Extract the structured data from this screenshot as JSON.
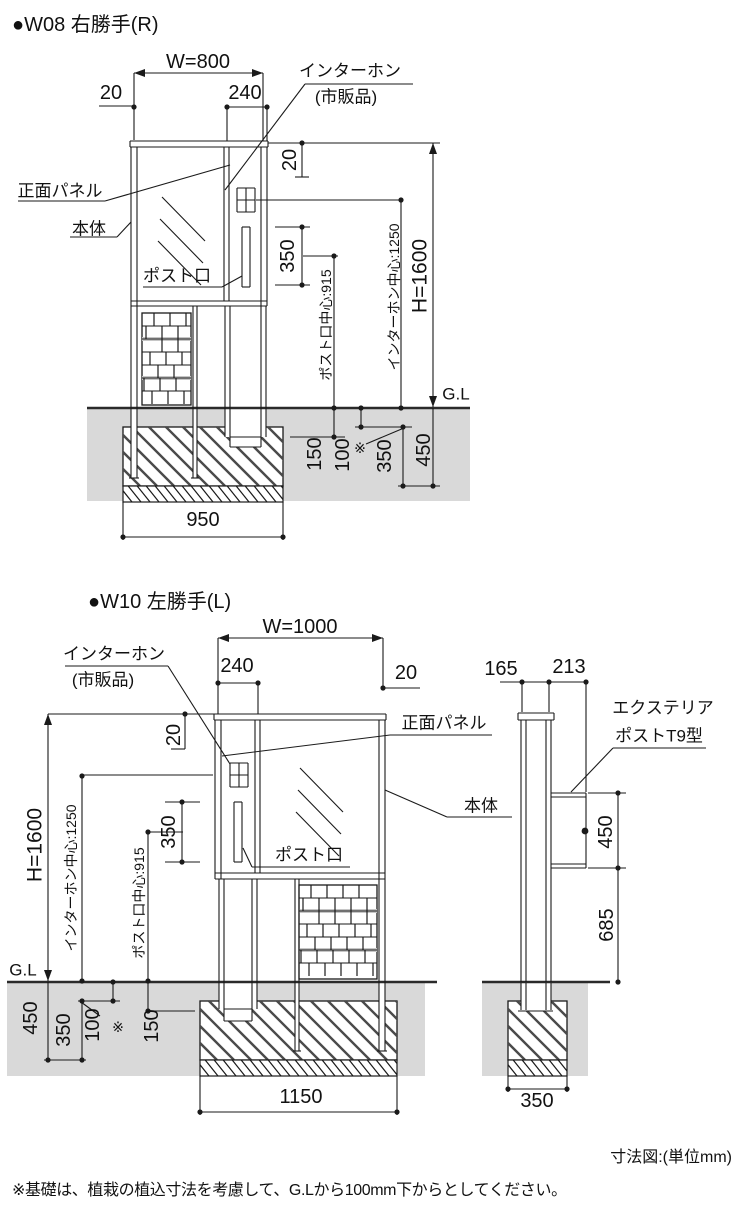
{
  "w08": {
    "title": "●W08 右勝手(R)",
    "dims": {
      "w": "W=800",
      "left20": "20",
      "p240": "240",
      "top20": "20",
      "slot350": "350",
      "post915": "ポスト口中心:915",
      "ic1250": "インターホン中心:1250",
      "h": "H=1600",
      "gl": "G.L",
      "d150": "150",
      "d100": "100",
      "ast": "※",
      "d350": "350",
      "d450": "450",
      "base": "950"
    },
    "labels": {
      "ic1": "インターホン",
      "ic2": "(市販品)",
      "front": "正面パネル",
      "body": "本体",
      "slot": "ポスト口"
    }
  },
  "w10": {
    "title": "●W10 左勝手(L)",
    "dims": {
      "w": "W=1000",
      "right20": "20",
      "p240": "240",
      "top20": "20",
      "slot350": "350",
      "post915": "ポスト口中心:915",
      "ic1250": "インターホン中心:1250",
      "h": "H=1600",
      "gl": "G.L",
      "d150": "150",
      "d100": "100",
      "ast": "※",
      "d350": "350",
      "d450": "450",
      "base": "1150"
    },
    "labels": {
      "ic1": "インターホン",
      "ic2": "(市販品)",
      "front": "正面パネル",
      "body": "本体",
      "slot": "ポスト口"
    }
  },
  "side": {
    "dims": {
      "d165": "165",
      "d213": "213",
      "d450": "450",
      "d685": "685",
      "base": "350"
    },
    "labels": {
      "post1": "エクステリア",
      "post2": "ポストT9型"
    }
  },
  "footer": {
    "unit": "寸法図:(単位mm)",
    "note": "※基礎は、植栽の植込寸法を考慮して、G.Lから100mm下からとしてください。"
  }
}
